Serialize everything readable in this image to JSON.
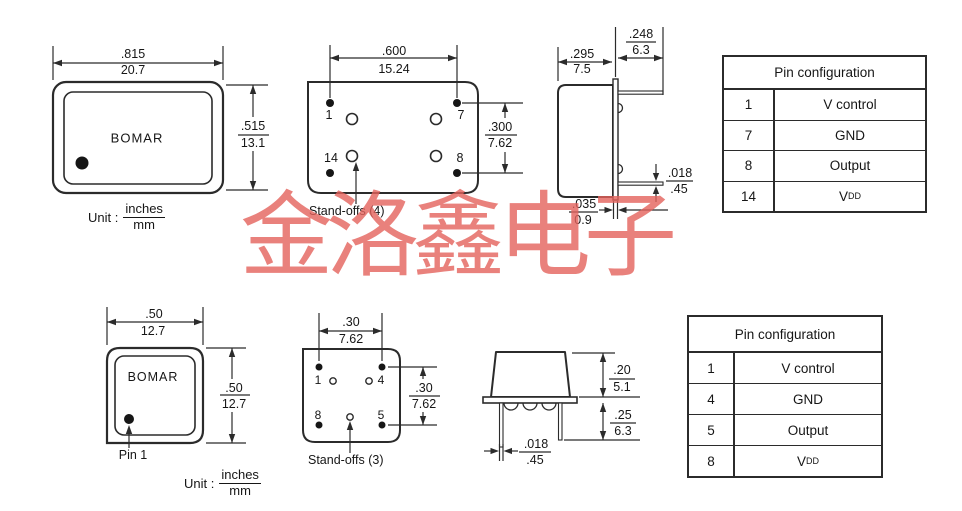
{
  "watermark": {
    "text": "金洛鑫电子",
    "color": "#e4625c"
  },
  "top_section": {
    "front_view": {
      "brand": "BOMAR",
      "width_dim": {
        "inches": ".815",
        "mm": "20.7"
      },
      "height_dim": {
        "inches": ".515",
        "mm": "13.1"
      },
      "unit": {
        "label": "Unit :",
        "numerator": "inches",
        "denominator": "mm"
      }
    },
    "bottom_view": {
      "pin_labels": {
        "p1": "1",
        "p7": "7",
        "p14": "14",
        "p8": "8"
      },
      "width_dim": {
        "inches": ".600",
        "mm": "15.24"
      },
      "height_dim": {
        "inches": ".300",
        "mm": "7.62"
      },
      "standoffs_label": "Stand-offs (4)"
    },
    "side_view": {
      "body_width_dim": {
        "inches": ".295",
        "mm": "7.5"
      },
      "lead_length_dim": {
        "inches": ".248",
        "mm": "6.3"
      },
      "lead_thickness_dim": {
        "inches": ".018",
        "mm": ".45"
      },
      "base_thickness_dim": {
        "inches": ".035",
        "mm": "0.9"
      }
    },
    "pin_table": {
      "title": "Pin configuration",
      "rows": [
        {
          "pin": "1",
          "function": "V control",
          "function_sub": ""
        },
        {
          "pin": "7",
          "function": "GND",
          "function_sub": ""
        },
        {
          "pin": "8",
          "function": "Output",
          "function_sub": ""
        },
        {
          "pin": "14",
          "function": "V",
          "function_sub": "DD"
        }
      ]
    }
  },
  "bottom_section": {
    "front_view": {
      "brand": "BOMAR",
      "width_dim": {
        "inches": ".50",
        "mm": "12.7"
      },
      "height_dim": {
        "inches": ".50",
        "mm": "12.7"
      },
      "pin1_label": "Pin 1",
      "unit": {
        "label": "Unit :",
        "numerator": "inches",
        "denominator": "mm"
      }
    },
    "bottom_view": {
      "pin_labels": {
        "p1": "1",
        "p4": "4",
        "p8": "8",
        "p5": "5"
      },
      "width_dim": {
        "inches": ".30",
        "mm": "7.62"
      },
      "height_dim": {
        "inches": ".30",
        "mm": "7.62"
      },
      "standoffs_label": "Stand-offs (3)"
    },
    "side_view": {
      "body_height_dim": {
        "inches": ".20",
        "mm": "5.1"
      },
      "lead_length_dim": {
        "inches": ".25",
        "mm": "6.3"
      },
      "lead_thickness_dim": {
        "inches": ".018",
        "mm": ".45"
      }
    },
    "pin_table": {
      "title": "Pin configuration",
      "rows": [
        {
          "pin": "1",
          "function": "V control",
          "function_sub": ""
        },
        {
          "pin": "4",
          "function": "GND",
          "function_sub": ""
        },
        {
          "pin": "5",
          "function": "Output",
          "function_sub": ""
        },
        {
          "pin": "8",
          "function": "V",
          "function_sub": "DD"
        }
      ]
    }
  }
}
